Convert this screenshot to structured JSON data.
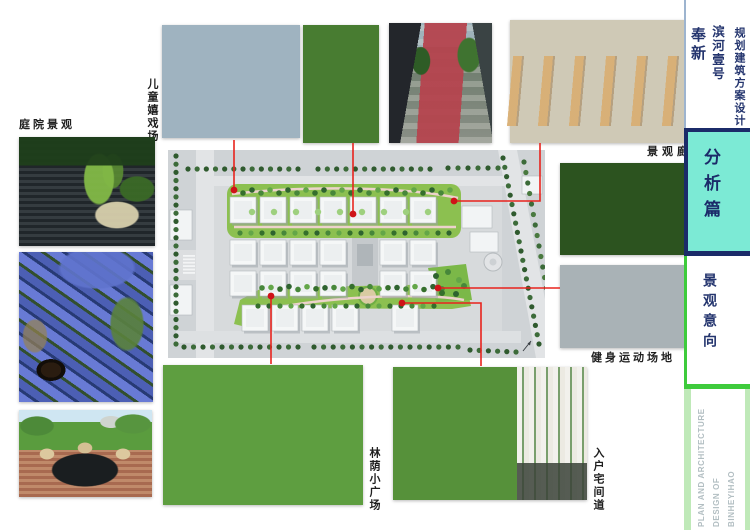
{
  "titleblock": {
    "project_name": "奉新",
    "project_subname": "滨河壹号",
    "doc_type": "规划建筑方案设计"
  },
  "sections": {
    "analysis_badge": "分析篇",
    "topic_label": "景观意向",
    "footer_lines": [
      "PLAN AND ARCHITECTURE",
      "DESIGN OF",
      "BINHEYIHAO"
    ]
  },
  "photo_labels": {
    "courtyard": "庭院景观",
    "children_playground": "儿童嬉戏场",
    "landscape_gallery": "景观廊",
    "fitness_ground": "健身运动场地",
    "shaded_plaza": "林荫小广场",
    "entry_lane": "入户宅间道"
  },
  "colors": {
    "connector_red": "#e8231d",
    "marker_red": "#cf1318",
    "badge_bg": "#7cead5",
    "navy": "#1b2b69",
    "text_navy": "#24356e",
    "accent_green": "#3ecb3c",
    "pale_green": "#bfe9b8",
    "caption_dark": "#1f1f1f"
  }
}
